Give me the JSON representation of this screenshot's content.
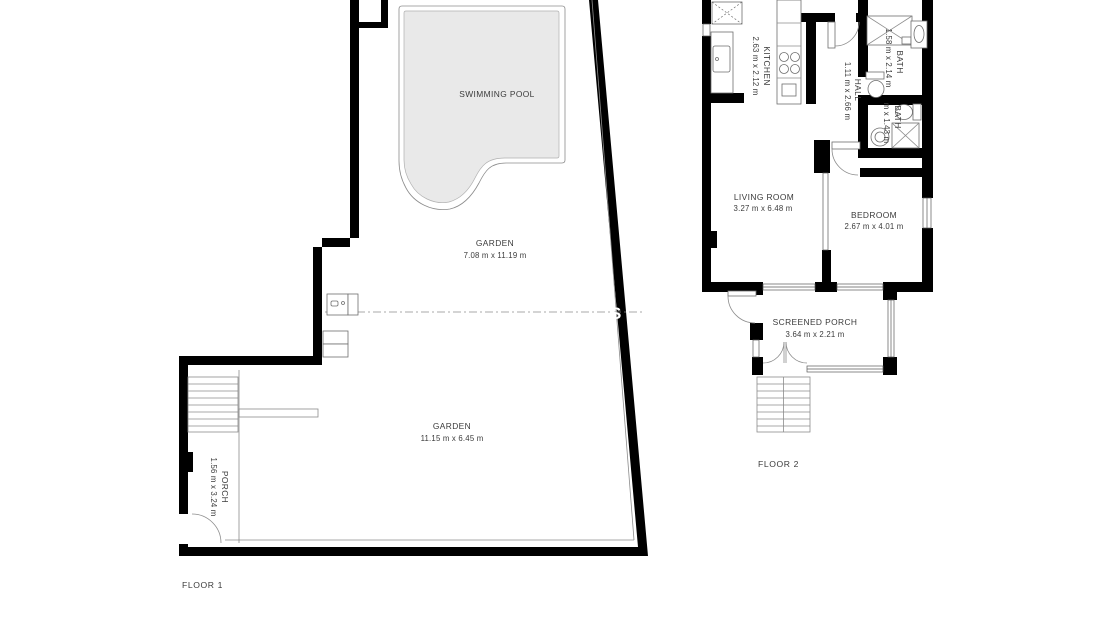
{
  "floor1": {
    "label": "FLOOR 1",
    "swimming_pool": {
      "name": "SWIMMING POOL"
    },
    "garden_upper": {
      "name": "GARDEN",
      "dims": "7.08 m x 11.19 m"
    },
    "garden_lower": {
      "name": "GARDEN",
      "dims": "11.15 m x 6.45 m"
    },
    "porch": {
      "name": "PORCH",
      "dims": "1.56 m x 3.24 m"
    }
  },
  "floor2": {
    "label": "FLOOR 2",
    "kitchen": {
      "name": "KITCHEN",
      "dims": "2.63 m x 2.12 m"
    },
    "hall": {
      "name": "HALL",
      "dims": "1.11 m x 2.66 m"
    },
    "bath_top": {
      "name": "BATH",
      "dims": "1.58 m x 2.14 m"
    },
    "bath_lower": {
      "name": "BATH",
      "dims_visible": "m x 1.43 m"
    },
    "living_room": {
      "name": "LIVING ROOM",
      "dims": "3.27 m x 6.48 m"
    },
    "bedroom": {
      "name": "BEDROOM",
      "dims": "2.67 m x 4.01 m"
    },
    "screened_porch": {
      "name": "SCREENED PORCH",
      "dims": "3.64 m x 2.21 m"
    }
  },
  "watermark": {
    "visible_text": "S"
  },
  "colors": {
    "background": "#ffffff",
    "wall": "#000000",
    "pool_fill": "#e9e9e9",
    "thin_line": "#8c8c8c",
    "text": "#3b3b3b",
    "watermark_text": "#ffffff"
  }
}
